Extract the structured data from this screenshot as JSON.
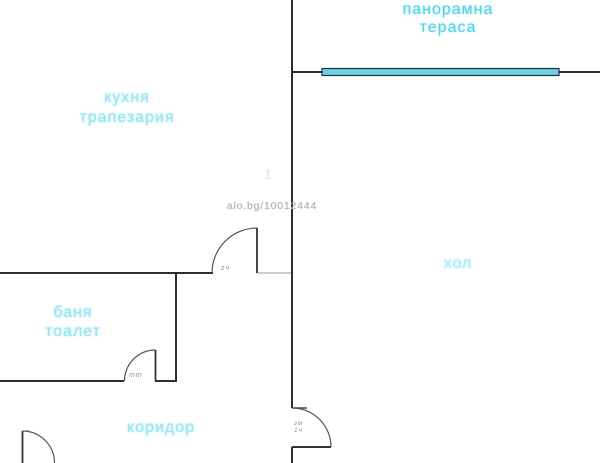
{
  "plan": {
    "width": 600,
    "height": 463,
    "type": "apartment-floor-plan"
  },
  "rooms": {
    "terrace": {
      "line1": "панорамна",
      "line2": "тераса"
    },
    "kitchen": {
      "line1": "кухня",
      "line2": "трапезария"
    },
    "hall": {
      "label": "хол"
    },
    "bathroom": {
      "line1": "баня",
      "line2": "тоалет"
    },
    "corridor": {
      "label": "коридор"
    }
  },
  "watermark": {
    "text": "alo.bg/10012444",
    "faint_digit": "1"
  },
  "door_annotations": {
    "kitchen_door": "гч",
    "bathroom_door": "тт",
    "hall_door": "зм\n1ч"
  },
  "colors": {
    "wall": "#2e2e2e",
    "wall_faint": "#bbbbbb",
    "door_arc": "#555555",
    "window_fill": "#70cfe1",
    "window_border": "#16333d",
    "label_cyan_strong": "#54d0e7",
    "label_cyan_light": "#97e6f0",
    "watermark_gray": "#b3b3b3"
  }
}
